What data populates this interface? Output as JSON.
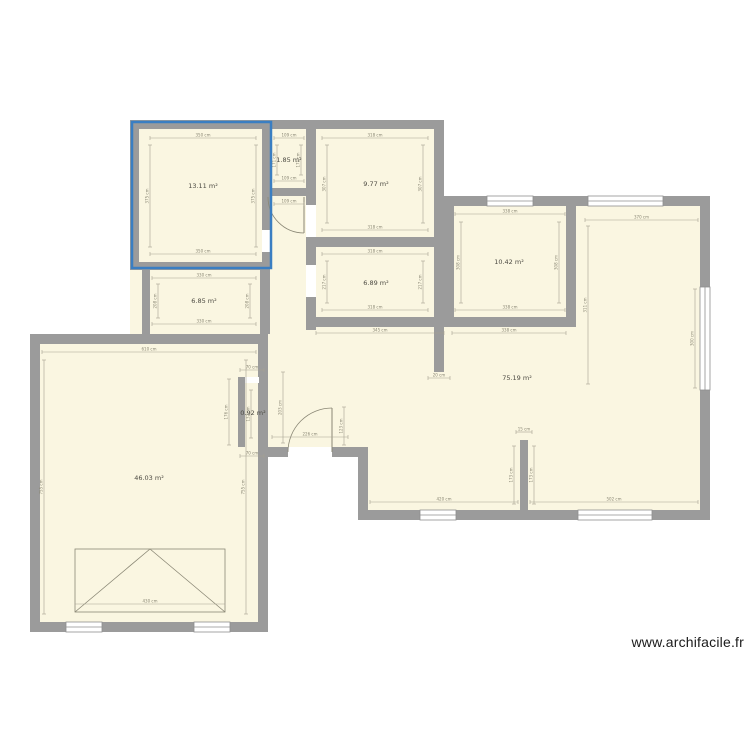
{
  "canvas": {
    "width": 750,
    "height": 750,
    "background": "#ffffff"
  },
  "watermark": {
    "text": "www.archifacile.fr"
  },
  "colors": {
    "wall": "#9b9b9b",
    "room_fill": "#faf6e1",
    "dim_line": "#a6a291",
    "dim_text": "#8a8775",
    "area_label": "#4c4a42",
    "window_fill": "#ffffff",
    "window_stroke": "#8f8f8f",
    "symbol": "#8a8775",
    "selection": "#3a7ec2",
    "watermark": "#1a1a1a"
  },
  "rooms": [
    {
      "id": "room-1",
      "area_label": "13.11 m²",
      "label_x": 203,
      "label_y": 188
    },
    {
      "id": "room-2",
      "area_label": "1.85 m²",
      "label_x": 289,
      "label_y": 162
    },
    {
      "id": "room-3",
      "area_label": "9.77 m²",
      "label_x": 376,
      "label_y": 186
    },
    {
      "id": "room-4",
      "area_label": "6.85 m²",
      "label_x": 204,
      "label_y": 303
    },
    {
      "id": "room-5",
      "area_label": "6.89 m²",
      "label_x": 376,
      "label_y": 285
    },
    {
      "id": "room-6",
      "area_label": "10.42 m²",
      "label_x": 509,
      "label_y": 264
    },
    {
      "id": "room-7",
      "area_label": "75.19 m²",
      "label_x": 517,
      "label_y": 380
    },
    {
      "id": "room-8",
      "area_label": "0.92 m²",
      "label_x": 253,
      "label_y": 415
    },
    {
      "id": "room-9",
      "area_label": "46.03 m²",
      "label_x": 149,
      "label_y": 480
    }
  ],
  "plan": {
    "floor_shapes": [
      "130,120 444,120 444,344 130,344",
      "444,196 710,196 710,520 444,520",
      "268,330 444,330 444,520 358,520 358,457 268,457",
      "30,334 268,334 268,632 30,632"
    ],
    "walls": [
      [
        130,
        120,
        314,
        9
      ],
      [
        130,
        129,
        9,
        141
      ],
      [
        262,
        129,
        8,
        133
      ],
      [
        306,
        129,
        10,
        201
      ],
      [
        270,
        188,
        36,
        8
      ],
      [
        130,
        262,
        140,
        8
      ],
      [
        142,
        270,
        8,
        64
      ],
      [
        260,
        270,
        10,
        64
      ],
      [
        434,
        120,
        10,
        252
      ],
      [
        316,
        237,
        118,
        10
      ],
      [
        306,
        317,
        128,
        10
      ],
      [
        444,
        196,
        266,
        10
      ],
      [
        444,
        206,
        10,
        121
      ],
      [
        566,
        206,
        10,
        121
      ],
      [
        444,
        317,
        132,
        10
      ],
      [
        700,
        206,
        10,
        314
      ],
      [
        358,
        510,
        352,
        10
      ],
      [
        358,
        457,
        10,
        53
      ],
      [
        260,
        447,
        108,
        10
      ],
      [
        30,
        334,
        238,
        10
      ],
      [
        30,
        344,
        10,
        288
      ],
      [
        30,
        622,
        238,
        10
      ],
      [
        258,
        344,
        10,
        288
      ],
      [
        520,
        440,
        8,
        70
      ],
      [
        238,
        377,
        7,
        70
      ],
      [
        238,
        377,
        28,
        6
      ]
    ],
    "windows": [
      [
        487,
        196,
        46,
        10
      ],
      [
        588,
        196,
        75,
        10
      ],
      [
        700,
        287,
        10,
        103
      ],
      [
        420,
        510,
        36,
        10
      ],
      [
        578,
        510,
        74,
        10
      ],
      [
        66,
        622,
        36,
        10
      ],
      [
        194,
        622,
        36,
        10
      ]
    ],
    "openings": [
      [
        306,
        205,
        10,
        32
      ],
      [
        306,
        265,
        10,
        32
      ],
      [
        262,
        230,
        8,
        22
      ],
      [
        288,
        447,
        44,
        10
      ],
      [
        245,
        377,
        14,
        6
      ]
    ],
    "doors": [
      {
        "leaf": [
          304,
          197,
          304,
          233
        ],
        "arc": "M304,233 A36,36 0 0 1 268,197"
      },
      {
        "leaf": [
          332,
          452,
          332,
          408
        ],
        "arc": "M332,408 A44,44 0 0 0 288,452"
      }
    ],
    "garage_door": {
      "x": 75,
      "y": 549,
      "w": 150,
      "h": 63,
      "diagonals": [
        [
          75,
          612,
          150,
          549
        ],
        [
          225,
          612,
          150,
          549
        ]
      ]
    },
    "dimensions": [
      [
        150,
        138,
        256,
        138,
        "350 cm"
      ],
      [
        150,
        254,
        256,
        254,
        "350 cm"
      ],
      [
        150,
        145,
        150,
        247,
        "375 cm"
      ],
      [
        256,
        145,
        256,
        247,
        "375 cm"
      ],
      [
        274,
        138,
        304,
        138,
        "109 cm"
      ],
      [
        274,
        181,
        304,
        181,
        "109 cm"
      ],
      [
        277,
        145,
        277,
        175,
        "171 cm"
      ],
      [
        301,
        145,
        301,
        175,
        "171 cm"
      ],
      [
        274,
        204,
        304,
        204,
        "109 cm"
      ],
      [
        322,
        138,
        428,
        138,
        "318 cm"
      ],
      [
        322,
        230,
        428,
        230,
        "318 cm"
      ],
      [
        327,
        145,
        327,
        223,
        "307 cm"
      ],
      [
        423,
        145,
        423,
        223,
        "307 cm"
      ],
      [
        322,
        254,
        428,
        254,
        "318 cm"
      ],
      [
        322,
        310,
        428,
        310,
        "318 cm"
      ],
      [
        327,
        261,
        327,
        303,
        "217 cm"
      ],
      [
        423,
        261,
        423,
        303,
        "217 cm"
      ],
      [
        316,
        333,
        444,
        333,
        "345 cm"
      ],
      [
        452,
        333,
        566,
        333,
        "338 cm"
      ],
      [
        455,
        214,
        565,
        214,
        "338 cm"
      ],
      [
        455,
        310,
        565,
        310,
        "338 cm"
      ],
      [
        461,
        222,
        461,
        303,
        "308 cm"
      ],
      [
        559,
        222,
        559,
        303,
        "308 cm"
      ],
      [
        152,
        278,
        256,
        278,
        "330 cm"
      ],
      [
        152,
        324,
        256,
        324,
        "330 cm"
      ],
      [
        158,
        284,
        158,
        318,
        "208 cm"
      ],
      [
        250,
        284,
        250,
        318,
        "208 cm"
      ],
      [
        42,
        352,
        256,
        352,
        "610 cm"
      ],
      [
        44,
        360,
        44,
        614,
        "755 cm"
      ],
      [
        246,
        360,
        246,
        614,
        "755 cm"
      ],
      [
        75,
        604,
        225,
        604,
        "430 cm"
      ],
      [
        585,
        220,
        698,
        220,
        "370 cm"
      ],
      [
        588,
        226,
        588,
        384,
        "311 cm"
      ],
      [
        695,
        289,
        695,
        388,
        "300 cm"
      ],
      [
        370,
        502,
        518,
        502,
        "420 cm"
      ],
      [
        530,
        502,
        698,
        502,
        "502 cm"
      ],
      [
        514,
        446,
        514,
        504,
        "173 cm"
      ],
      [
        534,
        446,
        534,
        504,
        "173 cm"
      ],
      [
        516,
        432,
        532,
        432,
        "15 cm"
      ],
      [
        428,
        378,
        450,
        378,
        "20 cm"
      ],
      [
        283,
        372,
        283,
        443,
        "203 cm"
      ],
      [
        272,
        437,
        348,
        437,
        "226 cm"
      ],
      [
        344,
        407,
        344,
        445,
        "123 cm"
      ],
      [
        229,
        379,
        229,
        445,
        "176 cm"
      ],
      [
        240,
        370,
        264,
        370,
        "70 cm"
      ],
      [
        240,
        456,
        264,
        456,
        "70 cm"
      ],
      [
        251,
        390,
        251,
        438,
        "132 cm"
      ]
    ],
    "selection": {
      "x": 132,
      "y": 122,
      "w": 139,
      "h": 146
    }
  }
}
